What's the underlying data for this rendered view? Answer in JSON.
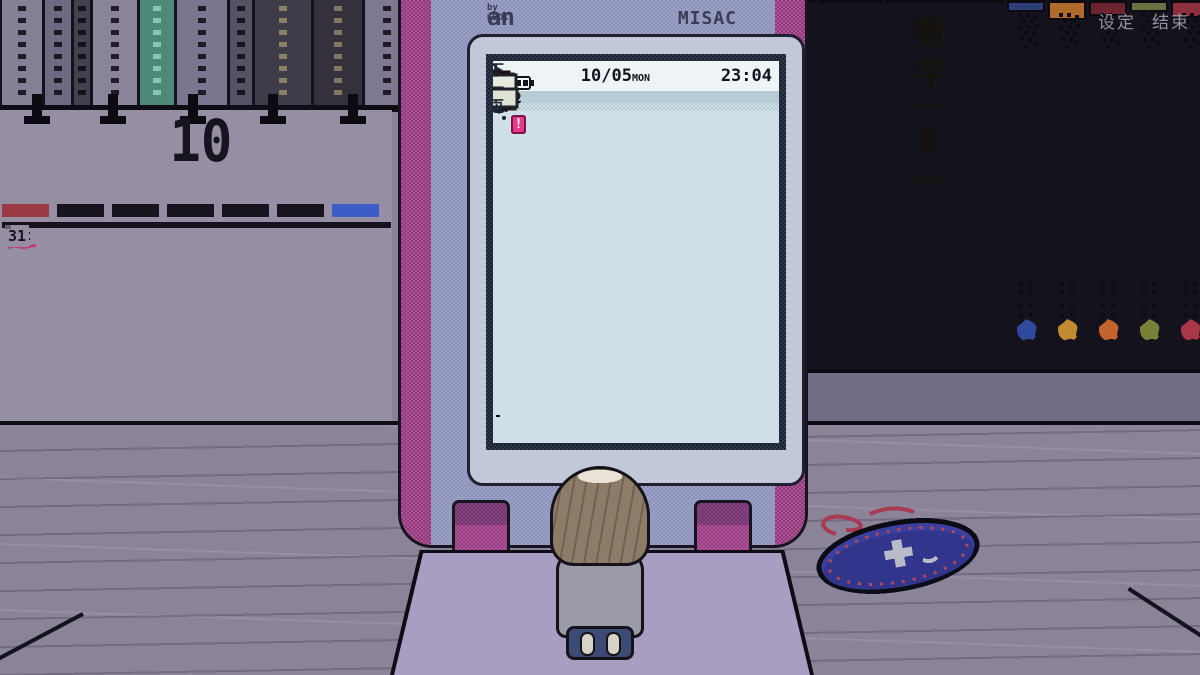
{
  "overlay": {
    "settings_label": "设定",
    "quit_label": "结束"
  },
  "phone": {
    "brand_left_main": "an",
    "brand_left_sub": "by KDDI",
    "brand_right": "MISAC",
    "status": {
      "date": "10/05",
      "weekday": "MON",
      "time": "23:04",
      "signal_bars": 2,
      "battery_bars": 3
    },
    "menu_items": [
      {
        "label": "邮件",
        "icon": "mail-envelope-icon",
        "selected": true,
        "badge": false,
        "dimmed": true
      },
      {
        "label": "J大陆",
        "icon": "j-land-icon",
        "selected": false,
        "badge": true,
        "dimmed": false
      },
      {
        "label": "电话",
        "icon": "rotary-phone-icon",
        "selected": false,
        "badge": false,
        "dimmed": true
      },
      {
        "label": "新闻",
        "icon": "newspaper-icon",
        "selected": false,
        "badge": true,
        "dimmed": false
      },
      {
        "label": "游戏",
        "icon": "game-screens-icon",
        "selected": false,
        "badge": false,
        "dimmed": false
      },
      {
        "label": "词典",
        "icon": "dictionary-icon",
        "selected": false,
        "badge": true,
        "dimmed": false
      },
      {
        "label": "储存",
        "icon": "save-card-icon",
        "selected": false,
        "badge": false,
        "dimmed": false
      },
      {
        "label": "读取",
        "icon": "load-card-icon",
        "selected": false,
        "badge": false,
        "dimmed": false
      },
      {
        "label": "下一页",
        "icon": "next-page-icon",
        "selected": false,
        "badge": false,
        "dimmed": false
      }
    ],
    "softkeys": [
      "",
      "",
      ""
    ]
  },
  "calendar": {
    "month": "10",
    "cells": [
      {
        "v": "",
        "t": "dim"
      },
      {
        "v": "",
        "t": "dim"
      },
      {
        "v": "",
        "t": "dim"
      },
      {
        "v": "1",
        "t": "wd"
      },
      {
        "v": "2",
        "t": "wd"
      },
      {
        "v": "3",
        "t": "wd"
      },
      {
        "v": "4",
        "t": "sat"
      },
      {
        "v": "5",
        "t": "sun",
        "m": "scribble"
      },
      {
        "v": "6",
        "t": "wd",
        "m": "scribble"
      },
      {
        "v": "7",
        "t": "wd"
      },
      {
        "v": "8",
        "t": "wd"
      },
      {
        "v": "9",
        "t": "wd"
      },
      {
        "v": "10",
        "t": "wd"
      },
      {
        "v": "11",
        "t": "sat",
        "m": "underline"
      },
      {
        "v": "12",
        "t": "sun"
      },
      {
        "v": "13",
        "t": "sun",
        "m": "dash"
      },
      {
        "v": "14",
        "t": "wd"
      },
      {
        "v": "15",
        "t": "wd"
      },
      {
        "v": "16",
        "t": "wd"
      },
      {
        "v": "17",
        "t": "wd"
      },
      {
        "v": "18",
        "t": "sat"
      },
      {
        "v": "19",
        "t": "sun"
      },
      {
        "v": "20",
        "t": "wd"
      },
      {
        "v": "21",
        "t": "wd"
      },
      {
        "v": "22",
        "t": "wd"
      },
      {
        "v": "23",
        "t": "wd"
      },
      {
        "v": "24",
        "t": "wd"
      },
      {
        "v": "25",
        "t": "sat"
      },
      {
        "v": "26",
        "t": "sun"
      },
      {
        "v": "27",
        "t": "wd"
      },
      {
        "v": "28",
        "t": "wd"
      },
      {
        "v": "29",
        "t": "wd"
      },
      {
        "v": "30",
        "t": "wd"
      },
      {
        "v": "31",
        "t": "wd"
      },
      {
        "v": "",
        "t": "dim"
      }
    ]
  },
  "bookshelf": {
    "math_book_title": "数学(Ⅱ)"
  },
  "colors": {
    "phone_pink": "#b2509a",
    "phone_face": "#9ba1c6",
    "screen_bg": "#cfe0e8",
    "badge_pink": "#e8388c",
    "calendar_red": "#a2353f",
    "calendar_blue": "#3a57c4",
    "pouch_blue": "#3b3f9e"
  }
}
